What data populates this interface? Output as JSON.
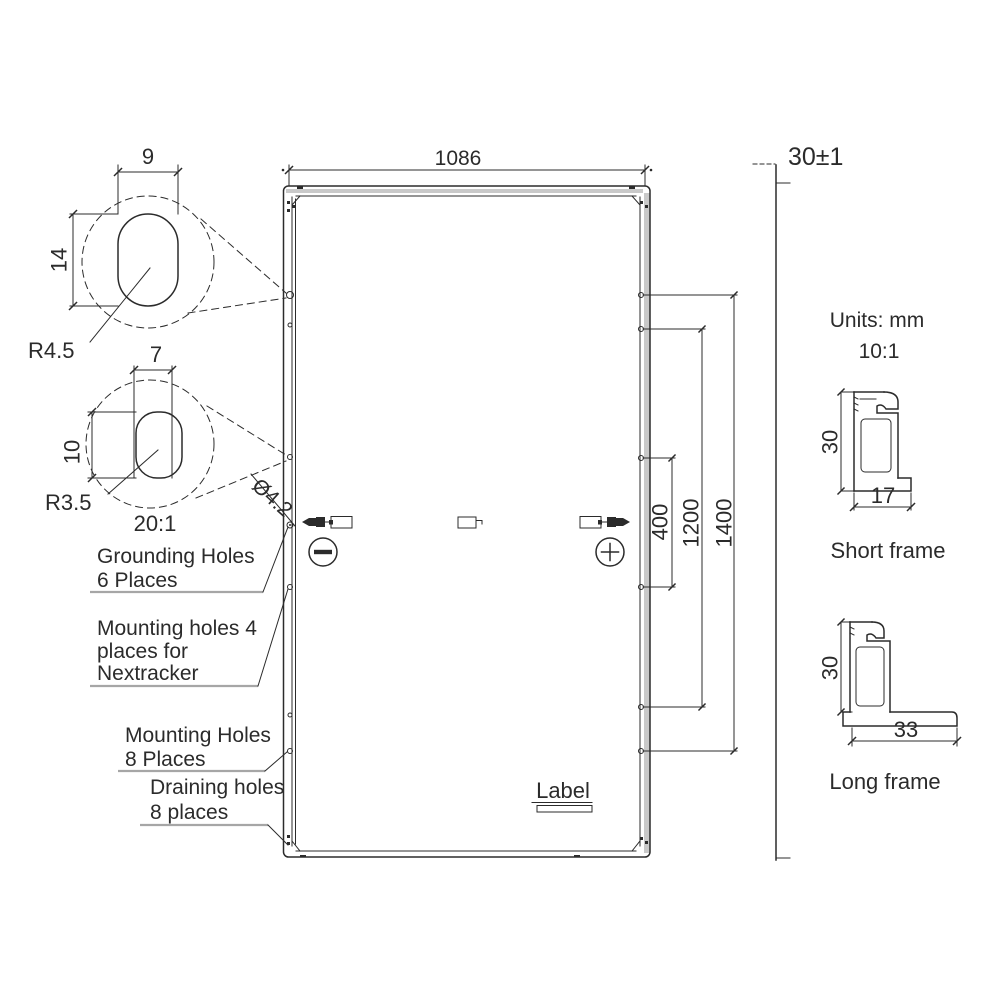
{
  "colors": {
    "ink": "#2b2b2b",
    "band": "#c9c9c9",
    "underline": "#a6a6a6",
    "background": "#ffffff"
  },
  "panel": {
    "dim_width": "1086",
    "dim_span_400": "400",
    "dim_span_1200": "1200",
    "dim_span_1400": "1400",
    "dim_thickness": "30±1",
    "grounding_hole_dia": "Ø4.2",
    "sticker_label": "Label"
  },
  "terminals": {
    "negative": "−",
    "positive": "+"
  },
  "detail_top": {
    "width": "9",
    "height": "14",
    "radius": "R4.5"
  },
  "detail_bottom": {
    "width": "7",
    "height": "10",
    "radius": "R3.5",
    "scale": "20:1"
  },
  "callouts": {
    "grounding": {
      "line1": "Grounding Holes",
      "line2": "6 Places"
    },
    "nextracker": {
      "line1": "Mounting holes 4",
      "line2": "places for",
      "line3": "Nextracker"
    },
    "mounting": {
      "line1": "Mounting Holes",
      "line2": "8 Places"
    },
    "draining": {
      "line1": "Draining holes",
      "line2": "8 places"
    }
  },
  "notes": {
    "units": "Units: mm",
    "scale": "10:1"
  },
  "profiles": {
    "short": {
      "label": "Short frame",
      "height": "30",
      "width": "17"
    },
    "long": {
      "label": "Long frame",
      "height": "30",
      "width": "33"
    }
  }
}
